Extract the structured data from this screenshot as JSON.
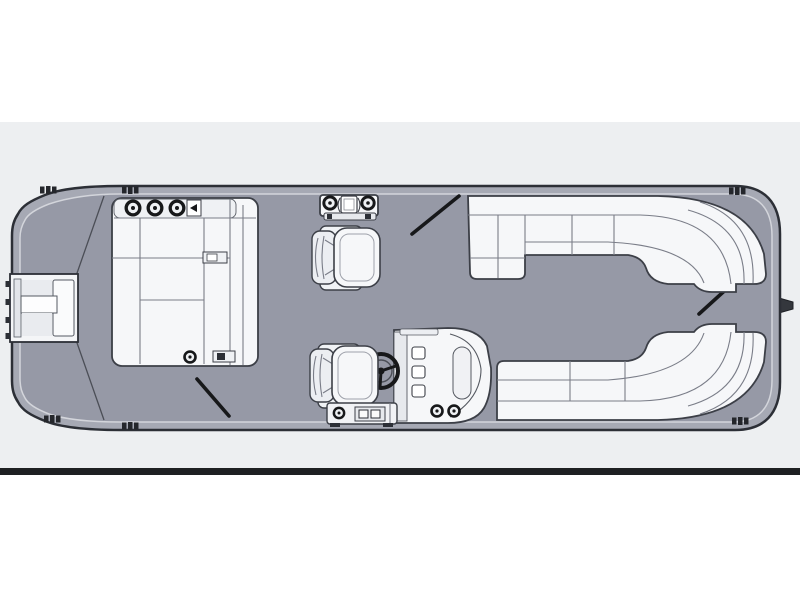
{
  "page": {
    "background_color": "#ffffff",
    "panel_background_color": "#edeff1",
    "divider_bar_color": "#1e2022"
  },
  "floorplan": {
    "subject": "pontoon-boat-floor-plan-top-view",
    "colors": {
      "deck": "#9699a6",
      "hull_rim": "#a6a9b4",
      "hull_outline": "#2c2f36",
      "deck_inner_line": "#d3d5db",
      "furniture_fill": "#f6f7f9",
      "furniture_shade": "#e9ebef",
      "furniture_outline": "#3c3f47",
      "detail_dark": "#17181a",
      "seam": "#7a7d88"
    },
    "components": [
      "boat-hull",
      "deck",
      "engine-pod",
      "bow-boarding-gate",
      "bow-lounge",
      "cupholder",
      "mooring-cleat",
      "cocktail-table",
      "companion-chair",
      "helm-chair",
      "helm-console",
      "steering-wheel",
      "helm-step-platform",
      "stern-lounge-top",
      "stern-lounge-bottom",
      "gate-opening-marker-bow",
      "gate-opening-marker-port",
      "gate-opening-marker-stern"
    ]
  }
}
